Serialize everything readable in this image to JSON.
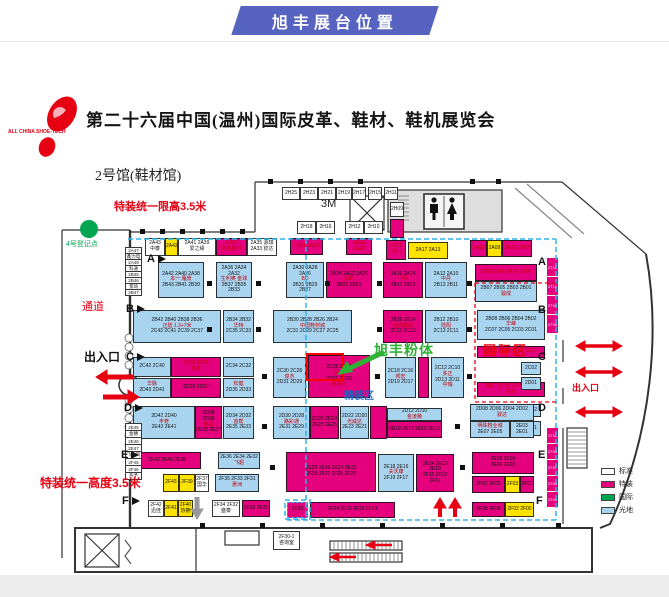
{
  "banner": {
    "text": "旭丰展台位置"
  },
  "logo": {
    "caption": "ALL CHINA SHOE-TECH"
  },
  "title": "第二十六届中国(温州)国际皮革、鞋材、鞋机展览会",
  "annotations": {
    "hall": "2号馆(鞋材馆)",
    "limit_top": "特装统一限高3.5米",
    "register": "4号登记点",
    "aisle": "通道",
    "exit_left": "出入口",
    "limit_bottom": "特装统一高度3.5米",
    "three_m": "3M",
    "target": "旭丰粉体",
    "intl_zone": "国际区",
    "fine_zone": "精装区",
    "exit_right": "出入口"
  },
  "colors": {
    "magenta": "#e5007d",
    "light_blue": "#a8d4f0",
    "yellow": "#ffe300",
    "green": "#00a550",
    "banner_blue": "#5663c1",
    "cyan_dash": "#2fb3e8",
    "red": "#e60012",
    "arrow_green": "#2eb135"
  },
  "legend": {
    "items": [
      {
        "label": "标准",
        "color": "#ffffff"
      },
      {
        "label": "特装",
        "color": "#e5007d"
      },
      {
        "label": "国际",
        "color": "#00a550"
      },
      {
        "label": "光地",
        "color": "#a8d4f0"
      }
    ]
  },
  "row_markers": {
    "left": [
      [
        "A",
        147,
        253
      ],
      [
        "B",
        126,
        303
      ],
      [
        "C",
        126,
        351
      ],
      [
        "D",
        124,
        402
      ],
      [
        "E",
        121,
        449
      ],
      [
        "F",
        122,
        495
      ]
    ],
    "right": [
      [
        "A",
        538,
        256
      ],
      [
        "B",
        538,
        304
      ],
      [
        "C",
        538,
        351
      ],
      [
        "D",
        538,
        402
      ],
      [
        "E",
        538,
        449
      ],
      [
        "F",
        536,
        495
      ]
    ]
  },
  "booths": [
    [
      145,
      238,
      20,
      18,
      "w",
      [
        "2A43",
        "中泰"
      ]
    ],
    [
      165,
      238,
      13,
      18,
      "y",
      [
        "2A42"
      ]
    ],
    [
      178,
      238,
      38,
      18,
      "w",
      [
        "2A41 2A39",
        "爱之缘"
      ]
    ],
    [
      216,
      238,
      31,
      18,
      "m",
      [
        [
          "2A37",
          "r"
        ],
        [
          "扬名鞋材",
          "r"
        ]
      ]
    ],
    [
      247,
      238,
      30,
      18,
      "w",
      [
        "2A35 源琪",
        "2A33 钦达"
      ]
    ],
    [
      290,
      238,
      33,
      17,
      "m",
      [
        [
          "2A31 2A29",
          "r"
        ]
      ]
    ],
    [
      346,
      238,
      26,
      17,
      "m",
      [
        [
          "2A25 2A23",
          "r"
        ]
      ]
    ],
    [
      386,
      240,
      20,
      20,
      "m",
      [
        [
          "2A21",
          "r"
        ],
        [
          "2A19",
          "r"
        ]
      ]
    ],
    [
      408,
      242,
      40,
      17,
      "y",
      [
        "2A17 2A13"
      ]
    ],
    [
      470,
      240,
      17,
      17,
      "m",
      [
        [
          "2A11",
          "r"
        ]
      ]
    ],
    [
      487,
      240,
      15,
      17,
      "y",
      [
        "2A09"
      ]
    ],
    [
      502,
      240,
      30,
      17,
      "m",
      [
        [
          "2A05 2A03",
          "r"
        ]
      ]
    ],
    [
      282,
      187,
      18,
      13,
      "w",
      [
        "2H25"
      ]
    ],
    [
      300,
      187,
      18,
      13,
      "w",
      [
        "2H23"
      ]
    ],
    [
      318,
      187,
      18,
      13,
      "w",
      [
        "2H21"
      ]
    ],
    [
      336,
      187,
      16,
      13,
      "w",
      [
        "2H19"
      ]
    ],
    [
      352,
      187,
      14,
      13,
      "w",
      [
        "2H17"
      ]
    ],
    [
      368,
      187,
      14,
      13,
      "w",
      [
        "2H15"
      ]
    ],
    [
      384,
      187,
      14,
      13,
      "w",
      [
        "2H11"
      ]
    ],
    [
      390,
      202,
      14,
      15,
      "w",
      [
        "2H09"
      ]
    ],
    [
      390,
      219,
      14,
      19,
      "m",
      []
    ],
    [
      297,
      221,
      19,
      13,
      "w",
      [
        "2H18"
      ]
    ],
    [
      316,
      221,
      19,
      13,
      "w",
      [
        "2H16"
      ]
    ],
    [
      345,
      221,
      19,
      13,
      "w",
      [
        "2H12"
      ]
    ],
    [
      364,
      221,
      19,
      13,
      "w",
      [
        "2H10"
      ]
    ],
    [
      158,
      262,
      46,
      36,
      "b",
      [
        "2A42 2A40 2A38",
        [
          "本一 雁景",
          "r"
        ],
        "2B43 2B41 2B39"
      ]
    ],
    [
      216,
      262,
      36,
      36,
      "b",
      [
        "2A36 2A34 2A32",
        [
          "生利奥 金球",
          "r"
        ],
        "2B37 2B35 2B33"
      ]
    ],
    [
      286,
      262,
      38,
      36,
      "b",
      [
        "2A30 2A28 2A26",
        [
          "BD",
          "r"
        ],
        "2B31 2B29 2B27"
      ]
    ],
    [
      326,
      262,
      46,
      36,
      "m",
      [
        "2A24 2A22 2A20",
        [
          "源利",
          "r"
        ],
        "2B23 2B21"
      ]
    ],
    [
      383,
      262,
      40,
      36,
      "m",
      [
        "2A16 2A14",
        [
          "飞扬",
          "r"
        ],
        "2B17 2B15"
      ]
    ],
    [
      425,
      262,
      42,
      36,
      "b",
      [
        "2A12 2A10",
        [
          "中丹",
          "r"
        ],
        "2B13 2B11"
      ]
    ],
    [
      475,
      264,
      62,
      17,
      "m",
      [
        [
          "2A08 2A06 2A04 2A02",
          "r"
        ]
      ]
    ],
    [
      475,
      281,
      62,
      21,
      "b",
      [
        "2B07 2B05 2B03 2B01",
        [
          "骏成",
          "r"
        ]
      ]
    ],
    [
      133,
      310,
      88,
      33,
      "b",
      [
        "2B42 2B40 2B38 2B36",
        [
          "正陆 1.3+7米",
          "r"
        ],
        "2C43 2C41 2C39 2C37"
      ]
    ],
    [
      223,
      310,
      31,
      33,
      "b",
      [
        "2B34 2B32",
        [
          "华特",
          "r"
        ],
        "2C35 2C33"
      ]
    ],
    [
      273,
      310,
      79,
      33,
      "b",
      [
        "2B30 2B28 2B26 2B24",
        [
          "中国鞋材城",
          "r"
        ],
        "2C31 2C29 2C27 2C25"
      ]
    ],
    [
      383,
      310,
      40,
      33,
      "m",
      [
        "2B16 2B14",
        [
          "台湾联成",
          "r"
        ],
        "2C17 2C15"
      ]
    ],
    [
      425,
      310,
      42,
      33,
      "b",
      [
        "2B12 2B10",
        [
          "陆阳",
          "r"
        ],
        "2C13 2C11"
      ]
    ],
    [
      477,
      310,
      68,
      30,
      "b",
      [
        "2B08 2B06 2B04 2B02",
        [
          "华峰",
          "r"
        ],
        "2C07 2C05 2C03 2C01"
      ]
    ],
    [
      133,
      357,
      38,
      20,
      "b",
      [
        "2C42 2C40"
      ]
    ],
    [
      171,
      357,
      50,
      20,
      "m",
      [
        [
          "2C38 2C36",
          "r"
        ],
        [
          "焕发",
          "r"
        ]
      ]
    ],
    [
      223,
      357,
      31,
      20,
      "b",
      [
        "2C34 2C32"
      ]
    ],
    [
      273,
      357,
      33,
      41,
      "b",
      [
        "2C30 2C28",
        [
          "俊杰",
          "r"
        ],
        "2D31 2D29"
      ]
    ],
    [
      308,
      355,
      62,
      43,
      "m",
      [
        "2C26 2C24",
        [
          "佳力",
          "r"
        ],
        "2D27 2D25",
        [
          "绿宝石",
          "r"
        ]
      ]
    ],
    [
      385,
      357,
      31,
      41,
      "b",
      [
        "2C18 2C16",
        [
          "邦宏",
          "r"
        ],
        "2D19 2D17"
      ]
    ],
    [
      418,
      357,
      11,
      41,
      "m",
      []
    ],
    [
      431,
      357,
      33,
      41,
      "b",
      [
        "2C12 2C10",
        [
          "多正",
          "r"
        ],
        "2D13 2D11",
        [
          "中瑞",
          "r"
        ]
      ]
    ],
    [
      477,
      346,
      68,
      12,
      "m",
      [
        [
          "2C08 2C06 2C04 2C02",
          "r"
        ]
      ]
    ],
    [
      477,
      382,
      68,
      15,
      "m",
      [
        [
          "2D07 2D05 2D03 2D01",
          "r"
        ],
        [
          "东方",
          "r"
        ]
      ]
    ],
    [
      521,
      362,
      20,
      13,
      "b",
      [
        "2C02"
      ]
    ],
    [
      521,
      377,
      20,
      13,
      "b",
      [
        "2D01"
      ]
    ],
    [
      521,
      404,
      20,
      13,
      "b",
      [
        "2D02"
      ]
    ],
    [
      521,
      421,
      20,
      15,
      "b",
      [
        "2E01"
      ]
    ],
    [
      133,
      378,
      38,
      20,
      "b",
      [
        [
          "华脉",
          "r"
        ],
        "2D43 2D41"
      ]
    ],
    [
      171,
      378,
      50,
      20,
      "m",
      [
        "2D39 2D37"
      ]
    ],
    [
      223,
      378,
      31,
      20,
      "b",
      [
        [
          "松健",
          "r"
        ],
        "2D35 2D33"
      ]
    ],
    [
      133,
      406,
      62,
      33,
      "b",
      [
        "2D42 2D40",
        [
          "丰奇",
          "r"
        ],
        "2E43 2E41"
      ]
    ],
    [
      195,
      406,
      27,
      33,
      "m",
      [
        "2D38 2D36",
        [
          "佳姿",
          "r"
        ],
        "2E39 2E37"
      ]
    ],
    [
      223,
      406,
      31,
      33,
      "b",
      [
        "2D34 2D32",
        [
          "首帮",
          "r"
        ],
        "2E35 2E33"
      ]
    ],
    [
      273,
      406,
      37,
      33,
      "b",
      [
        "2D30 2D28",
        [
          "路彩通",
          "r"
        ],
        "2E31 2E29"
      ]
    ],
    [
      310,
      406,
      29,
      33,
      "m",
      [
        "2D26 2D24",
        "2E27 2E25"
      ]
    ],
    [
      340,
      406,
      29,
      33,
      "b",
      [
        "2D22 2D20",
        [
          "光威达",
          "r"
        ],
        "2E23 2E21"
      ]
    ],
    [
      370,
      406,
      17,
      33,
      "m",
      []
    ],
    [
      387,
      408,
      55,
      13,
      "b",
      [
        "2D12 2D10",
        [
          "金凌薇",
          "r"
        ]
      ]
    ],
    [
      387,
      421,
      55,
      17,
      "m",
      [
        "2E19 2E17 2E15 2E13"
      ]
    ],
    [
      470,
      404,
      64,
      17,
      "b",
      [
        "2D08 2D06 2D04 2D02",
        [
          "骏达",
          "r"
        ]
      ]
    ],
    [
      470,
      421,
      40,
      17,
      "b",
      [
        [
          "明珠鞋业城",
          "r"
        ],
        "2E07 2E05"
      ]
    ],
    [
      510,
      421,
      24,
      17,
      "b",
      [
        "2E03 2E01"
      ]
    ],
    [
      133,
      452,
      68,
      17,
      "m",
      [
        "2E42 2E40 2E38"
      ]
    ],
    [
      218,
      452,
      42,
      17,
      "b",
      [
        "2E36 2E34 2E32",
        [
          "飞超",
          "r"
        ]
      ]
    ],
    [
      286,
      452,
      90,
      40,
      "m",
      [
        "2E28 2E26 2E24 2E22",
        "2F29 2F27 2F25 2F23"
      ]
    ],
    [
      378,
      454,
      36,
      38,
      "b",
      [
        "2E18 2E16",
        [
          "夫沃康",
          "r"
        ],
        "2F19 2F17"
      ]
    ],
    [
      416,
      454,
      38,
      38,
      "m",
      [
        "2E14 2E12 2E10",
        "2F15 2F13 2F11"
      ]
    ],
    [
      472,
      452,
      62,
      22,
      "m",
      [
        "2E08 2E06",
        "2E04 2E02"
      ]
    ],
    [
      163,
      474,
      16,
      18,
      "y",
      [
        "2F43"
      ]
    ],
    [
      179,
      474,
      16,
      18,
      "y",
      [
        "2F39"
      ]
    ],
    [
      195,
      474,
      14,
      18,
      "w",
      [
        "2F37",
        "国华"
      ]
    ],
    [
      215,
      474,
      44,
      18,
      "b",
      [
        "2F35 2F33 2F31",
        [
          "惠洲",
          "r"
        ]
      ]
    ],
    [
      148,
      500,
      16,
      17,
      "w",
      [
        "2F42",
        "迅佳"
      ]
    ],
    [
      164,
      500,
      14,
      17,
      "y",
      [
        "2F41"
      ]
    ],
    [
      178,
      500,
      15,
      17,
      "y",
      [
        "2F40",
        "协拥"
      ]
    ],
    [
      212,
      500,
      28,
      17,
      "w",
      [
        "2F34 2F32",
        "盛泰"
      ]
    ],
    [
      242,
      500,
      28,
      17,
      "m",
      [
        "2F28 2F26"
      ]
    ],
    [
      287,
      502,
      21,
      16,
      "m",
      [
        "2F30"
      ],
      "dash"
    ],
    [
      310,
      502,
      85,
      16,
      "m",
      [
        "2F24 2F22 2F20 2F18"
      ]
    ],
    [
      472,
      502,
      33,
      15,
      "m",
      [
        "2F08 2F06"
      ]
    ],
    [
      505,
      502,
      29,
      15,
      "y",
      [
        "2F02 2F00"
      ]
    ],
    [
      472,
      476,
      33,
      17,
      "m",
      [
        "2F07 2F05"
      ]
    ],
    [
      505,
      476,
      15,
      17,
      "y",
      [
        "2F03"
      ]
    ],
    [
      520,
      476,
      14,
      17,
      "m",
      [
        "2F01"
      ]
    ],
    [
      273,
      531,
      27,
      19,
      "w",
      [
        "2F30-1",
        "咨询室"
      ]
    ]
  ],
  "stacks": [
    [
      125,
      248,
      17,
      7,
      "w",
      [
        "2A47",
        "鑫力电",
        "2A49",
        "科通",
        "2B45",
        "2B46",
        "景琦",
        "2B47"
      ]
    ],
    [
      125,
      424,
      17,
      8,
      "w",
      [
        "2E45",
        "金穗",
        "2E46",
        "2E47",
        "飞力风",
        "2F45",
        "2F46",
        "热予"
      ]
    ],
    [
      546,
      258,
      13,
      20,
      "t",
      [
        "2T12",
        "2T10",
        "2T08",
        "2T06"
      ]
    ],
    [
      546,
      428,
      13,
      17,
      "t",
      [
        "2T11",
        "2T09",
        "2T07",
        "2T05",
        "2T03"
      ]
    ]
  ]
}
